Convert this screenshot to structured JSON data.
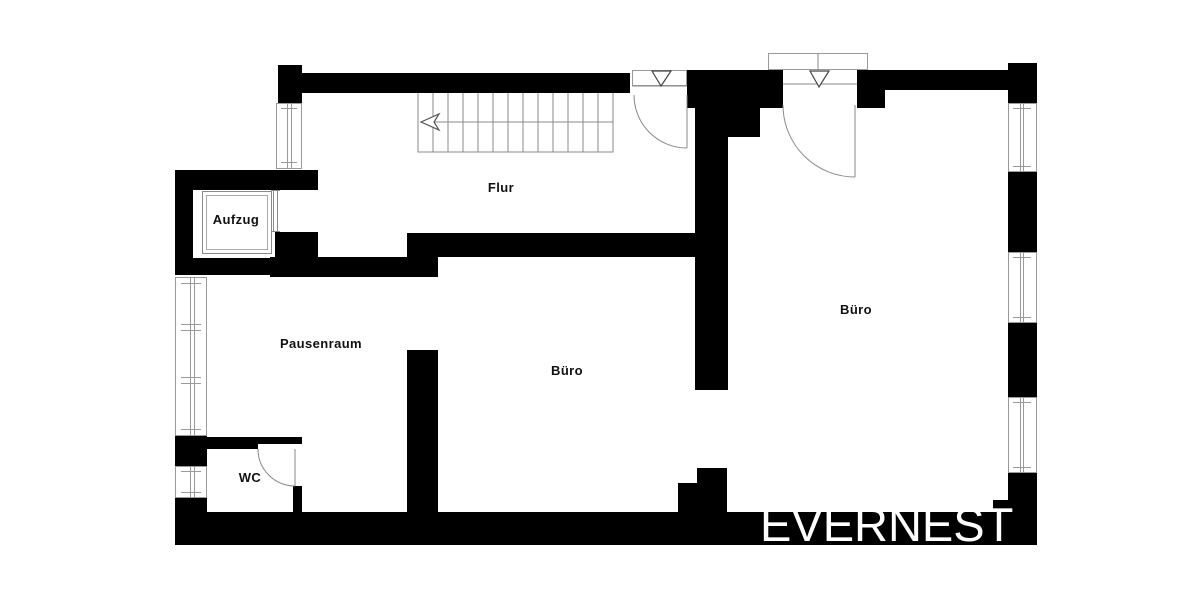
{
  "floorplan": {
    "title": "Floor plan",
    "watermark": "EVERNEST",
    "rooms": [
      {
        "id": "flur",
        "label": "Flur"
      },
      {
        "id": "aufzug",
        "label": "Aufzug"
      },
      {
        "id": "pausenraum",
        "label": "Pausenraum"
      },
      {
        "id": "buero-mitte",
        "label": "Büro"
      },
      {
        "id": "buero-rechts",
        "label": "Büro"
      },
      {
        "id": "wc",
        "label": "WC"
      }
    ],
    "features": {
      "stairs": "staircase with direction arrow pointing left",
      "entrances": 2,
      "windows": 6,
      "elevator": "Aufzug cabin with sliding door"
    },
    "colors": {
      "wall": "#000000",
      "thin_line": "#8a8a8a",
      "label": "#111111",
      "watermark": "#ffffff",
      "background": "#ffffff"
    }
  }
}
